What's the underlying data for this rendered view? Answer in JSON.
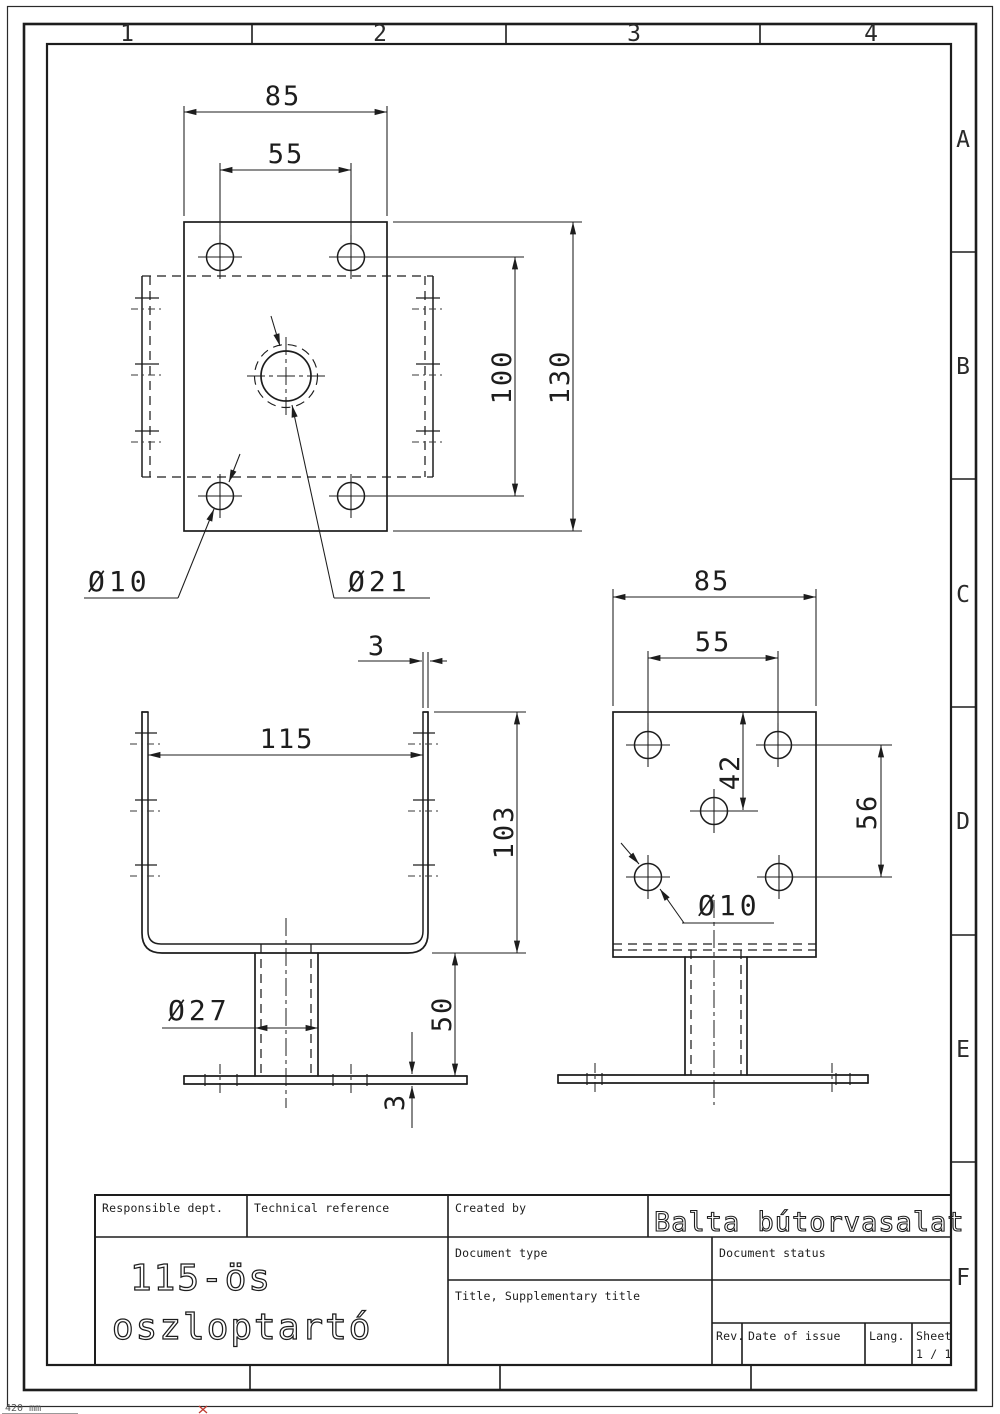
{
  "sheet": {
    "zones_top": [
      "1",
      "2",
      "3",
      "4"
    ],
    "zones_right": [
      "A",
      "B",
      "C",
      "D",
      "E",
      "F"
    ],
    "size_note": "420 mm"
  },
  "title_block": {
    "responsible_dept_label": "Responsible dept.",
    "technical_reference_label": "Technical reference",
    "created_by_label": "Created by",
    "company": "Balta bútorvasalat",
    "document_type_label": "Document type",
    "document_status_label": "Document status",
    "title_label": "Title, Supplementary title",
    "part_title_line1": "115-ös",
    "part_title_line2": "oszloptartó",
    "rev_label": "Rev.",
    "date_of_issue_label": "Date of issue",
    "lang_label": "Lang.",
    "sheet_label": "Sheet",
    "sheet_number": "1 / 1"
  },
  "views": {
    "top": {
      "dim_width": "85",
      "dim_holes_x": "55",
      "dim_holes_y": "100",
      "dim_depth": "130",
      "label_hole": "Ø10",
      "label_center_hole": "Ø21"
    },
    "front": {
      "dim_wall": "3",
      "dim_inner_width": "115",
      "dim_height": "103",
      "dim_tube_height": "50",
      "dim_base_thickness": "3",
      "label_tube": "Ø27"
    },
    "side": {
      "dim_width": "85",
      "dim_holes_x": "55",
      "dim_top_to_center": "42",
      "dim_holes_y": "56",
      "label_hole": "Ø10"
    }
  }
}
